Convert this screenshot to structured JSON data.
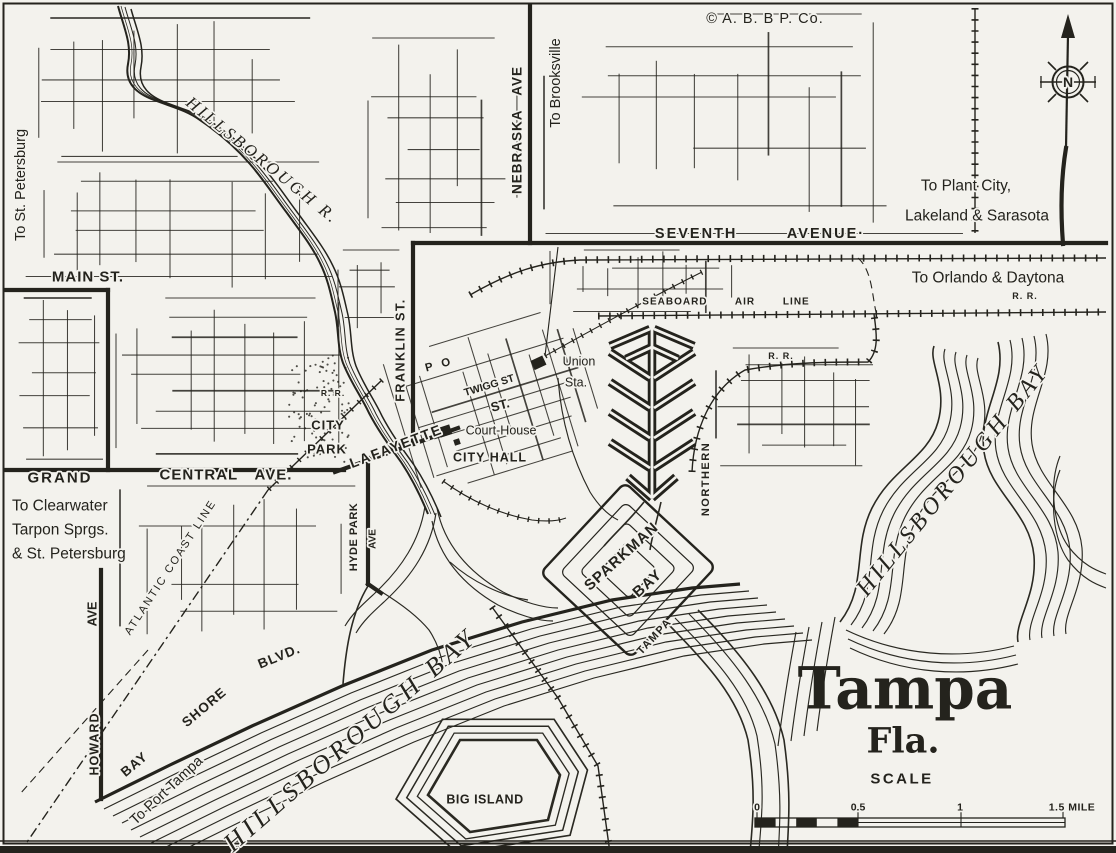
{
  "attribution": "© A. B. B P. Co.",
  "compass": {
    "north_letter": "N"
  },
  "title_block": {
    "city": "Tampa",
    "state": "Fla.",
    "scale_heading": "SCALE"
  },
  "scale_bar": {
    "tick_0": "0",
    "tick_half": "0.5",
    "tick_1": "1",
    "tick_end": "1.5 MILE"
  },
  "destinations": {
    "st_petersburg_west": "To St. Petersburg",
    "brooksville": "To Brooksville",
    "plant_city_line1": "To Plant City,",
    "plant_city_line2": "Lakeland & Sarasota",
    "orlando_daytona": "To Orlando & Daytona",
    "clearwater_line1": "To Clearwater",
    "clearwater_line2": "Tarpon Sprgs.",
    "clearwater_line3": "& St. Petersburg",
    "port_tampa": "To Port Tampa"
  },
  "streets": {
    "main": "MAIN ST.",
    "grand": "GRAND",
    "central": "CENTRAL AVE.",
    "seventh": "SEVENTH AVENUE·",
    "nebraska": "NEBRASKA AVE",
    "franklin": "FRANKLIN ST.",
    "lafayette": "LAFAYETTE",
    "twigg": "TWIGG ST",
    "twigg_st2": "ST.",
    "hyde_park": "HYDE PARK",
    "hyde_park_ave": "AVE",
    "howard": "HOWARD",
    "howard_ave": "AVE",
    "bay_word": "BAY",
    "shore_word": "SHORE",
    "blvd_word": "BLVD."
  },
  "railroads": {
    "seaboard_air_line": "SEABOARD AIR LINE",
    "atlantic_coast_line": "ATLANTIC COAST LINE",
    "tampa_word": "TAMPA",
    "northern_word": "NORTHERN",
    "rr_orlando": "R. R.",
    "rr_loop": "R. R.",
    "rr_city_park": "R. R."
  },
  "places": {
    "union_line1": "Union",
    "union_line2": "Sta.",
    "court_house": "Court-House",
    "city_hall": "CITY HALL",
    "city_park_line1": "CITY",
    "city_park_line2": "PARK",
    "post_office": "P O",
    "big_island": "BIG ISLAND"
  },
  "water": {
    "river": "HILLSBOROUGH R.",
    "bay_west": "HILLSBOROUGH BAY",
    "bay_east": "HILLSBOROUGH BAY",
    "sparkman_line1": "SPARKMAN",
    "sparkman_line2": "BAY"
  },
  "colors": {
    "paper": "#f3f2ed",
    "ink": "#24231d"
  }
}
